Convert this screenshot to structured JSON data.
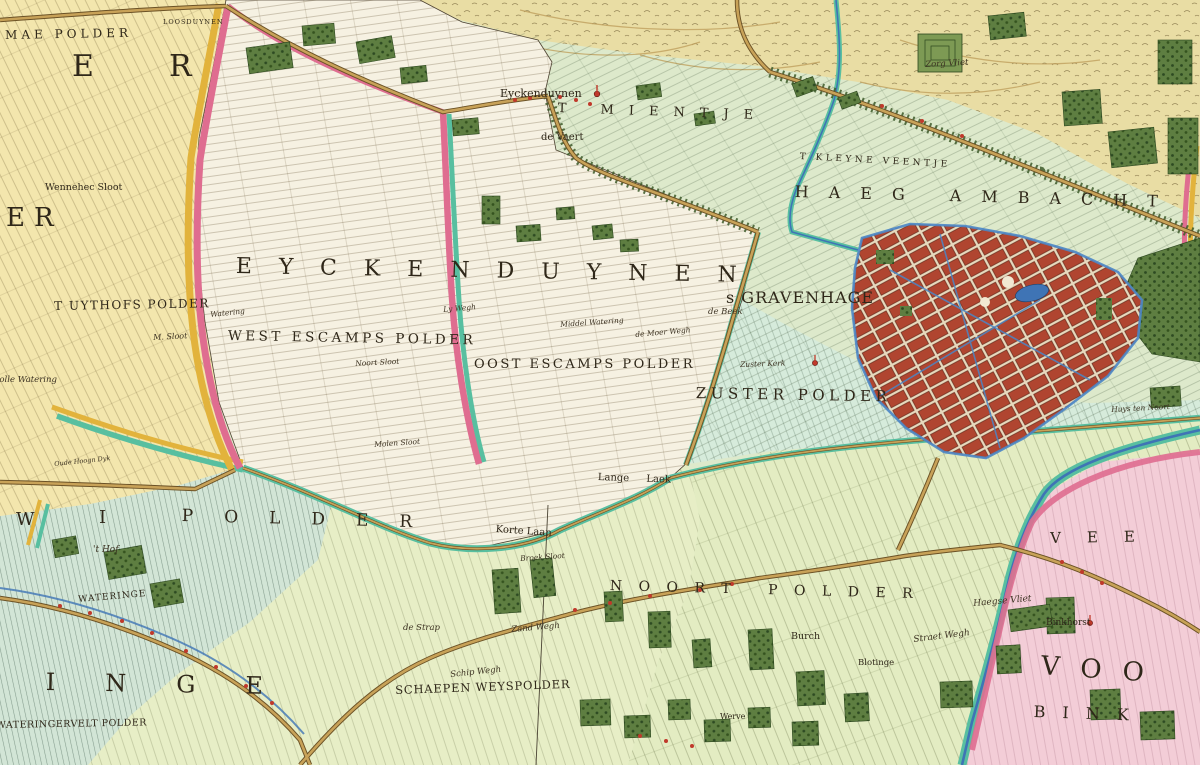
{
  "palette": {
    "base_green": "#dde9cb",
    "dune_sand": "#e9dda4",
    "polder_white": "#f6f1e2",
    "polder_yellow": "#f3e6ad",
    "polder_pink": "#f3cdd7",
    "city_red": "#b04530",
    "canal_blue": "#3f74b5",
    "border_teal": "#58bfa0",
    "border_pink": "#df6d90",
    "border_yellow": "#e2b33c",
    "woods_green": "#5e7e41",
    "road_ochre": "#c8a258"
  },
  "symbols": {
    "church_icon": "red chapel dot",
    "church_count": 3
  },
  "labels": {
    "eyckenduynen": "EYCKENDUYNEN",
    "haeg_ambacht": "HAEG AMBACHT",
    "t_mientje": "T MIENTJE",
    "t_kleyne_veentje": "T KLEYNE VEENTJE",
    "noort_polder": "NOORT POLDER",
    "zuster_polder": "ZUSTER POLDER",
    "west_escamps": "WEST ESCAMPS POLDER",
    "oost_escamps": "OOST ESCAMPS POLDER",
    "uythofs_polder": "T UYTHOFS POLDER",
    "mae_polder": "MAE POLDER",
    "schaepen_weyspolder": "SCHAEPEN WEYSPOLDER",
    "wateringervelt_polder": "WATERINGERVELT POLDER",
    "gravenhage": "s GRAVENHAGE",
    "loosduynen": "LOOSDUYNEN",
    "frag_e": "E",
    "frag_r": "R",
    "frag_er": "ER",
    "frag_w": "W",
    "frag_i": "I",
    "frag_polder": "POLDER",
    "frag_inge": "INGE",
    "frag_vee": "VEE",
    "frag_voo": "VOO",
    "frag_bink": "BINK",
    "village": "Eyckenduynen",
    "de_vaert": "de Vaert",
    "zorg_vliet": "Zorg Vliet",
    "wennehec_sloot": "Wennehec Sloot",
    "holle_watering": "Holle Watering",
    "m_sloot": "M. Sloot",
    "watering": "Watering",
    "ly_wegh": "Ly Wegh",
    "noort_sloot": "Noort Sloot",
    "molen_sloot": "Molen Sloot",
    "middel_watering": "Middel Watering",
    "de_moer_wegh": "de Moer Wegh",
    "de_beek": "de Beek",
    "zuster_kerk": "Zuster Kerk",
    "lange_laek": "Lange Laek",
    "korte_laan": "Korte Laan",
    "broek_sloot": "Broek Sloot",
    "de_strap": "de Strap",
    "zand_wegh": "Zand Wegh",
    "schip_wegh": "Schip Wegh",
    "t_hof": "'t Hof",
    "oude_hoogn_dyk": "Oude Hoogn Dyk",
    "wateringe": "WATERINGE",
    "burch": "Burch",
    "blotinge": "Blotinge",
    "straet_wegh": "Straet Wegh",
    "haegse_vliet": "Haegse Vliet",
    "binkhorst": "Binkhorst",
    "huys_ten_noort": "Huys ten Noort",
    "werve": "Werve"
  }
}
